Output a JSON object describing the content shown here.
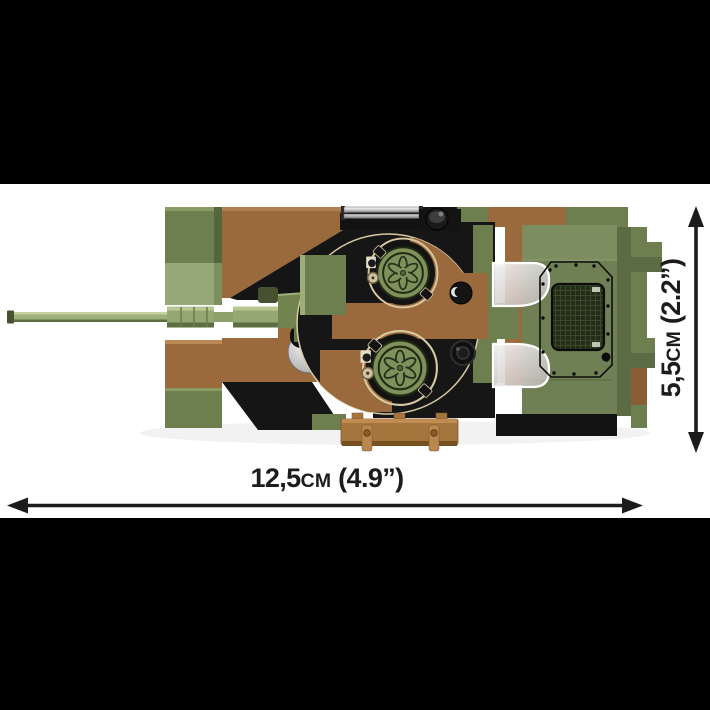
{
  "image": {
    "alt": "Top view of a brick-built military tank model in green and brown camouflage with measurement arrows"
  },
  "letterbox": {
    "color": "#000000"
  },
  "stage": {
    "background": "#ffffff"
  },
  "dimensions": {
    "width": {
      "value": "12,5",
      "unit": "cm",
      "imperial": " (4.9”)"
    },
    "height": {
      "value": "5,5",
      "unit": "cm",
      "imperial": " (2.2”)"
    }
  },
  "palette": {
    "camo_green": "#6d7f4f",
    "camo_green_light": "#97a878",
    "camo_green_dark": "#55663d",
    "deck_green": "#6f8154",
    "hatch_green": "#7e915a",
    "barrel_green": "#9eb07a",
    "camo_brown": "#9a6a3c",
    "camo_brown_dark": "#7d552f",
    "plank_brown": "#a5753e",
    "black_brick": "#161616",
    "tan_rim": "#d9c9a2",
    "chrome": "#d9d9d9",
    "glass": "#e8e6e8",
    "arrow_color": "#1c1c1c",
    "label_color": "#1c1c1c"
  }
}
